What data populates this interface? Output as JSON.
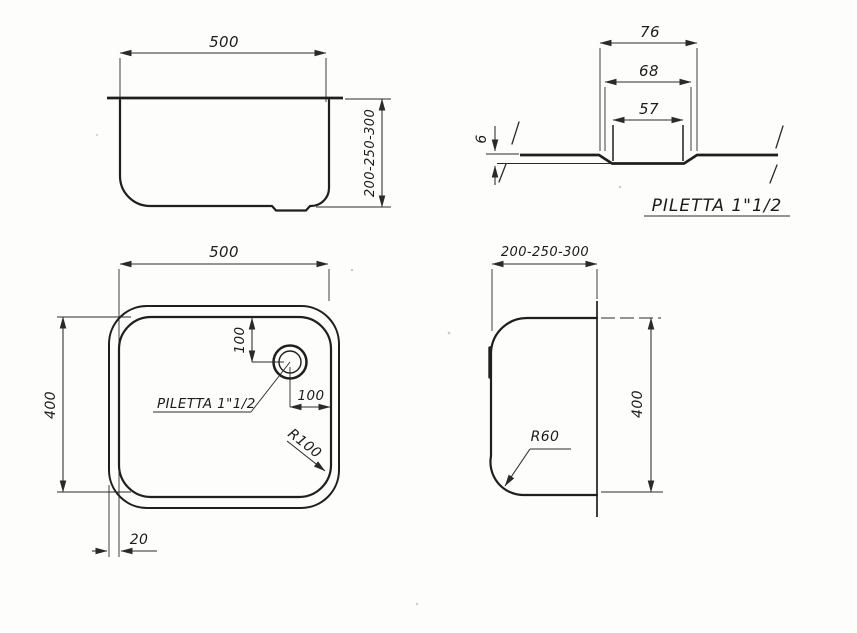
{
  "page": {
    "background_color": "#fdfdfc",
    "ink_color": "#2a2a2a",
    "description": "Technical dimensioned drawing of a rectangular sink bowl, four views"
  },
  "views": {
    "front": {
      "width": "500",
      "depth": "200-250-300"
    },
    "section": {
      "outer_width": "76",
      "mid_width": "68",
      "hole_width": "57",
      "depth": "6",
      "label": "PILETTA 1\"1/2"
    },
    "plan": {
      "width": "500",
      "length": "400",
      "drain_from_top": "100",
      "drain_from_right": "100",
      "corner_radius": "R100",
      "flange_width": "20",
      "drain_label": "PILETTA 1\"1/2"
    },
    "side": {
      "depth": "200-250-300",
      "length": "400",
      "corner_radius": "R60"
    }
  }
}
